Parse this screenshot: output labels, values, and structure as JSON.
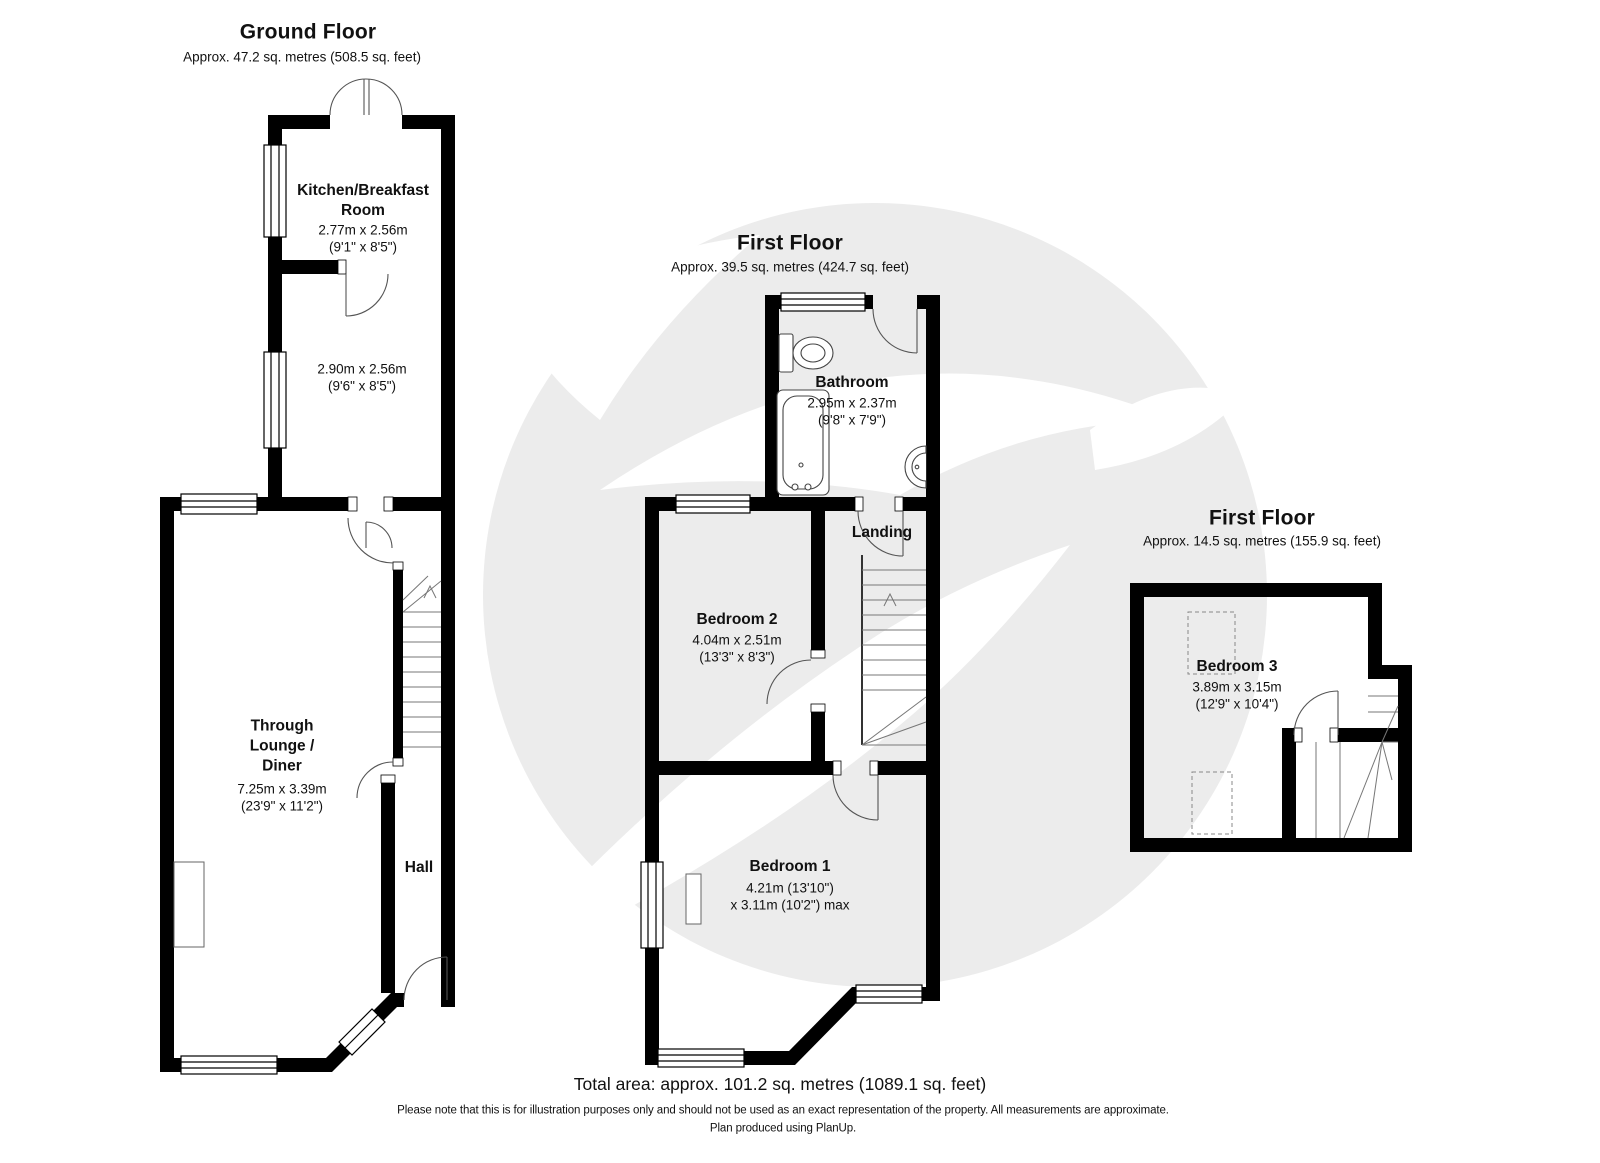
{
  "ground_floor": {
    "title": "Ground Floor",
    "subtitle": "Approx. 47.2 sq. metres (508.5 sq. feet)",
    "kitchen_name": "Kitchen/Breakfast\nRoom",
    "kitchen_dims": "2.77m x 2.56m\n(9'1\" x 8'5\")",
    "rear_room_dims": "2.90m x 2.56m\n(9'6\" x 8'5\")",
    "lounge_name": "Through\nLounge /\nDiner",
    "lounge_dims": "7.25m x 3.39m\n(23'9\" x 11'2\")",
    "hall_name": "Hall"
  },
  "first_floor": {
    "title": "First Floor",
    "subtitle": "Approx. 39.5 sq. metres (424.7 sq. feet)",
    "bathroom_name": "Bathroom",
    "bathroom_dims": "2.95m x 2.37m\n(9'8\" x 7'9\")",
    "landing_name": "Landing",
    "bedroom2_name": "Bedroom 2",
    "bedroom2_dims": "4.04m x 2.51m\n(13'3\" x 8'3\")",
    "bedroom1_name": "Bedroom 1",
    "bedroom1_dims": "4.21m (13'10\")\nx 3.11m (10'2\") max"
  },
  "second_floor": {
    "title": "First Floor",
    "subtitle": "Approx. 14.5 sq. metres (155.9 sq. feet)",
    "bedroom3_name": "Bedroom 3",
    "bedroom3_dims": "3.89m x 3.15m\n(12'9\" x 10'4\")"
  },
  "footer": {
    "total_area": "Total area: approx. 101.2 sq. metres (1089.1 sq. feet)",
    "disclaimer": "Please note that this is for illustration purposes only and should not be used as an exact representation of the property. All measurements are approximate.",
    "produced": "Plan produced using PlanUp."
  },
  "colors": {
    "wall": "#000000",
    "watermark_circle": "#ececec",
    "door_arc": "#555555",
    "stair_line": "#777777",
    "text": "#111111"
  }
}
